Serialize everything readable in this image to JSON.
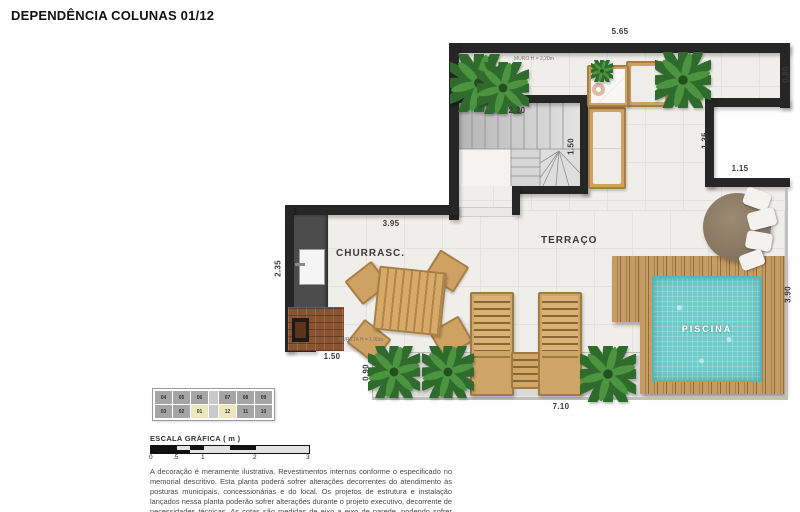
{
  "title": "DEPENDÊNCIA COLUNAS 01/12",
  "plan": {
    "labels": {
      "terrace": "TERRAÇO",
      "barbecue": "CHURRASC.",
      "pool": "PISCINA",
      "wall_note": "MURO H = 2,20m",
      "parapet_note": "MURETA H = 1,00m"
    },
    "dimensions": {
      "top_width": "5.65",
      "right_top": "0.80",
      "stairs_width": "2.20",
      "stairs_height": "1.50",
      "recess_height": "1.35",
      "recess_width": "1.15",
      "bbq_width": "3.95",
      "bbq_height": "2.35",
      "bbq_bottom": "1.50",
      "planter_height": "0.90",
      "bottom_width": "7.10",
      "pool_side": "3.90"
    }
  },
  "key_plan": {
    "rows": [
      [
        "04",
        "05",
        "06",
        "07",
        "08",
        "09"
      ],
      [
        "03",
        "02",
        "01",
        "12",
        "11",
        "10"
      ]
    ],
    "highlighted": [
      "01",
      "12"
    ]
  },
  "scale_bar": {
    "label": "ESCALA GRÁFICA ( m )",
    "ticks": [
      "0",
      ".5",
      "1",
      "2",
      "3"
    ]
  },
  "disclaimer": "A decoração é meramente ilustrativa. Revestimentos internos conforme o especificado no memorial descritivo. Esta planta poderá sofrer alterações decorrentes do atendimento às posturas municipais, concessionárias e do local. Os projetos de estrutura e instalação lançados nessa planta poderão sofrer alterações durante o projeto executivo, decorrente de necessidades técnicas. As cotas são medidas de eixo a eixo de parede, podendo sofrer variação de até 5% durante a obra.",
  "colors": {
    "wall": "#262626",
    "pool_water": "#6fcccb",
    "wood": "#cda263",
    "unit_highlight": "#ece7bd"
  }
}
